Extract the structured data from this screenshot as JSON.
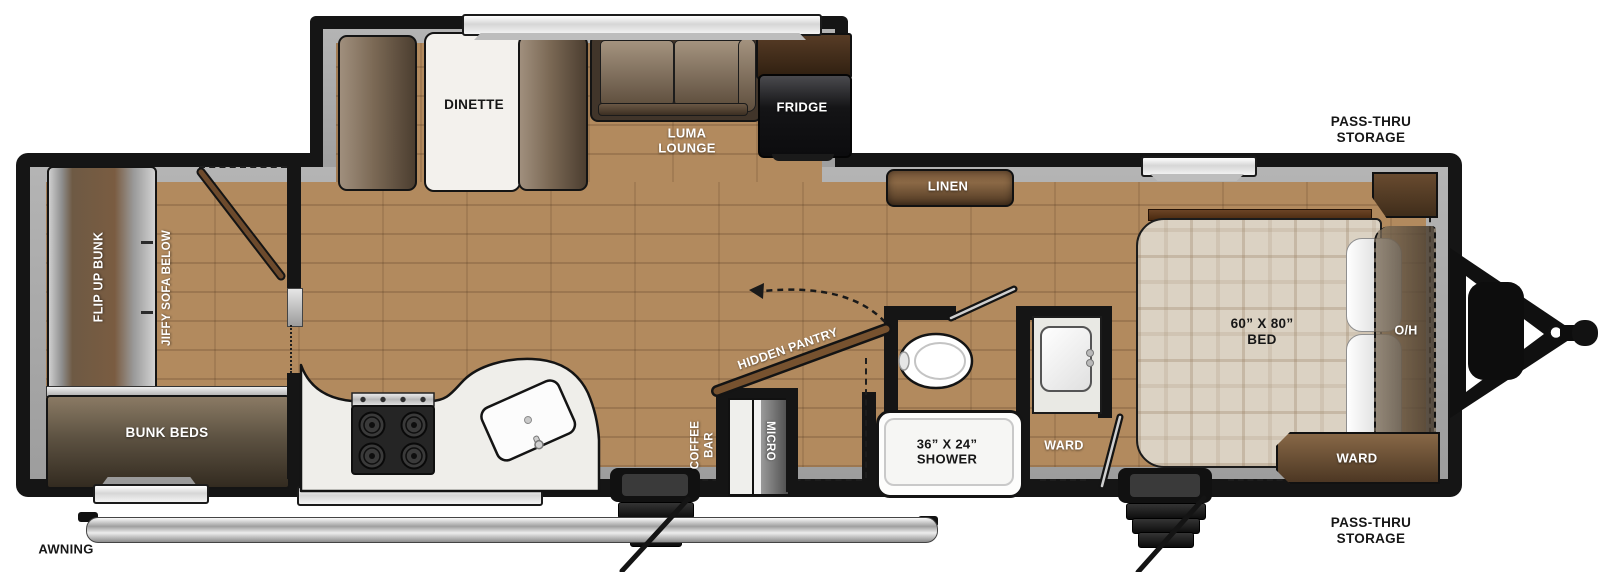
{
  "scene": "Overhead floor plan of a bunkhouse travel trailer",
  "colors": {
    "wall": "#151515",
    "interior_trim": "#a8a8a8",
    "wood_floor": "#b28a5e",
    "cabinet_wood": "#6f4f33",
    "counter_white": "#efeeea",
    "bed_plaid": "#dbd2c3",
    "appliance_black": "#141416",
    "exterior": "#ffffff"
  },
  "labels": {
    "dinette": "DINETTE",
    "luma_lounge": "LUMA\nLOUNGE",
    "fridge": "FRIDGE",
    "linen": "LINEN",
    "pass_thru_top": "PASS-THRU\nSTORAGE",
    "pass_thru_bottom": "PASS-THRU\nSTORAGE",
    "bed": "60” X 80”\nBED",
    "oh": "O/H",
    "ward_bedroom": "WARD",
    "ward_bath": "WARD",
    "shower": "36” X 24”\nSHOWER",
    "hidden_pantry": "HIDDEN PANTRY",
    "coffee_bar": "COFFEE\nBAR",
    "micro": "MICRO",
    "bunk_beds": "BUNK BEDS",
    "flip_up_bunk": "FLIP UP BUNK",
    "jiffy_sofa": "JIFFY SOFA BELOW",
    "awning": "AWNING"
  }
}
